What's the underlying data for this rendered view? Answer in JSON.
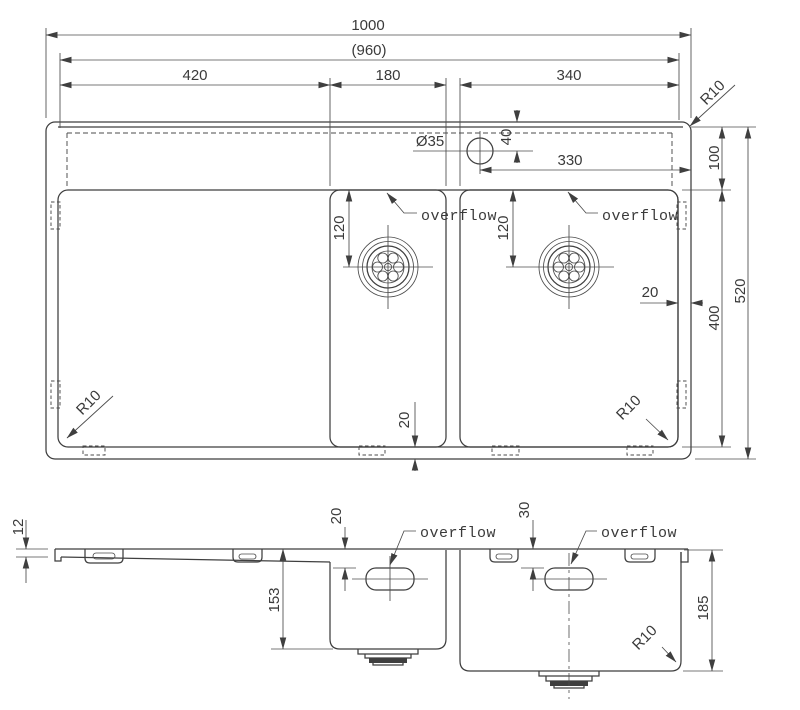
{
  "drawing_type": "sink technical drawing",
  "top_view": {
    "overall_width": "1000",
    "inner_width": "(960)",
    "drainboard_width": "420",
    "bowl1_width": "180",
    "bowl2_width": "340",
    "faucet_hole_dia": "Ø35",
    "faucet_from_back": "40",
    "faucet_from_right": "330",
    "ledge_depth": "100",
    "bowl_zone_depth": "400",
    "overall_depth": "520",
    "side_gap": "20",
    "front_gap": "20",
    "drain1_offset": "120",
    "drain2_offset": "120",
    "radius_back_right": "R10",
    "radius_front_left": "R10",
    "radius_front_right": "R10",
    "overflow_bowl1": "overflow",
    "overflow_bowl2": "overflow"
  },
  "side_view": {
    "rim_height": "12",
    "overflow1_depth": "20",
    "overflow2_depth": "30",
    "bowl1_depth": "153",
    "bowl2_depth": "185",
    "corner_radius": "R10",
    "overflow_bowl1": "overflow",
    "overflow_bowl2": "overflow"
  }
}
